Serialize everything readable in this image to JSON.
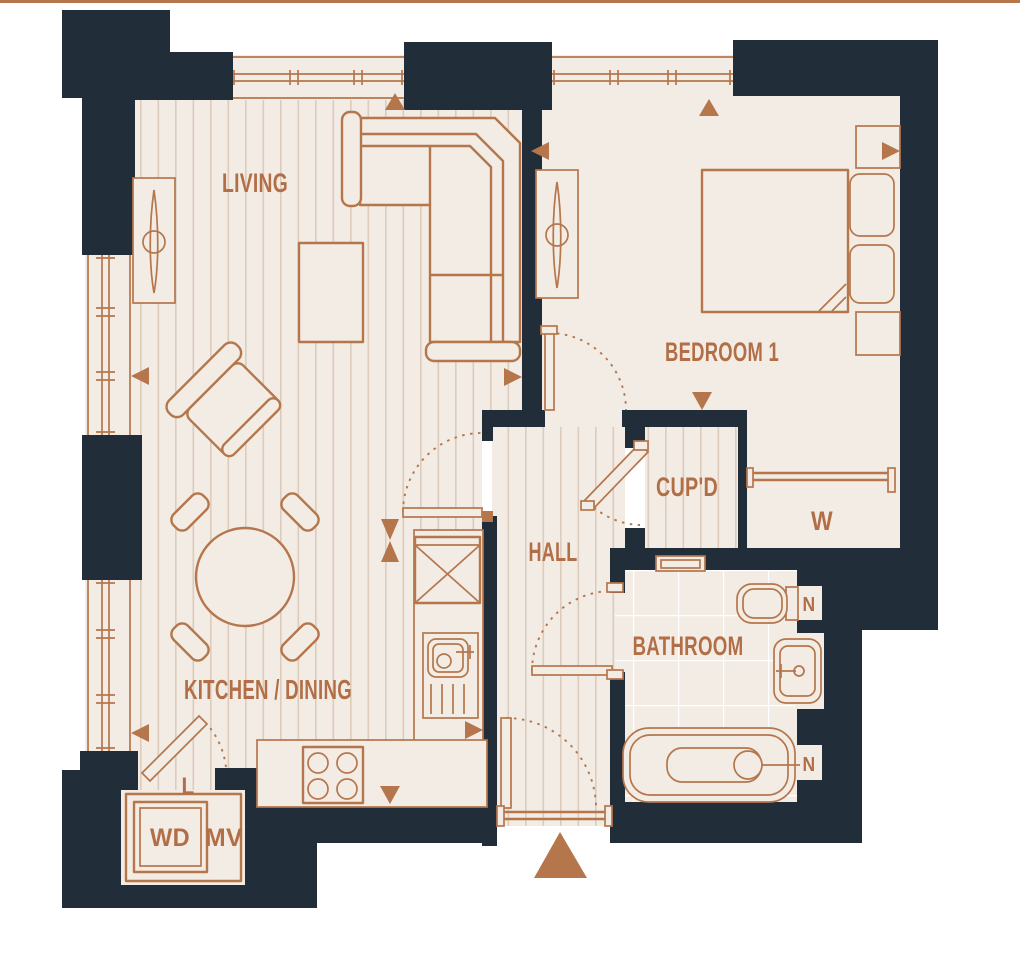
{
  "theme": {
    "wall": "#222d3a",
    "copper": "#b5764c",
    "copper_text": "#b26f47",
    "floor": "#f2ece4",
    "plank": "#ddccbc",
    "tile": "#ffffff",
    "bg": "#ffffff"
  },
  "plan": {
    "rooms": {
      "living": "LIVING",
      "bedroom1": "BEDROOM 1",
      "cupboard": "CUP'D",
      "hall": "HALL",
      "bathroom": "BATHROOM",
      "kitchen_dining": "KITCHEN / DINING"
    },
    "fixtures": {
      "wardrobe": "W",
      "linen": "L",
      "washer_dryer": "WD",
      "vent": "MV",
      "niche_toilet": "N",
      "niche_bath": "N"
    }
  }
}
